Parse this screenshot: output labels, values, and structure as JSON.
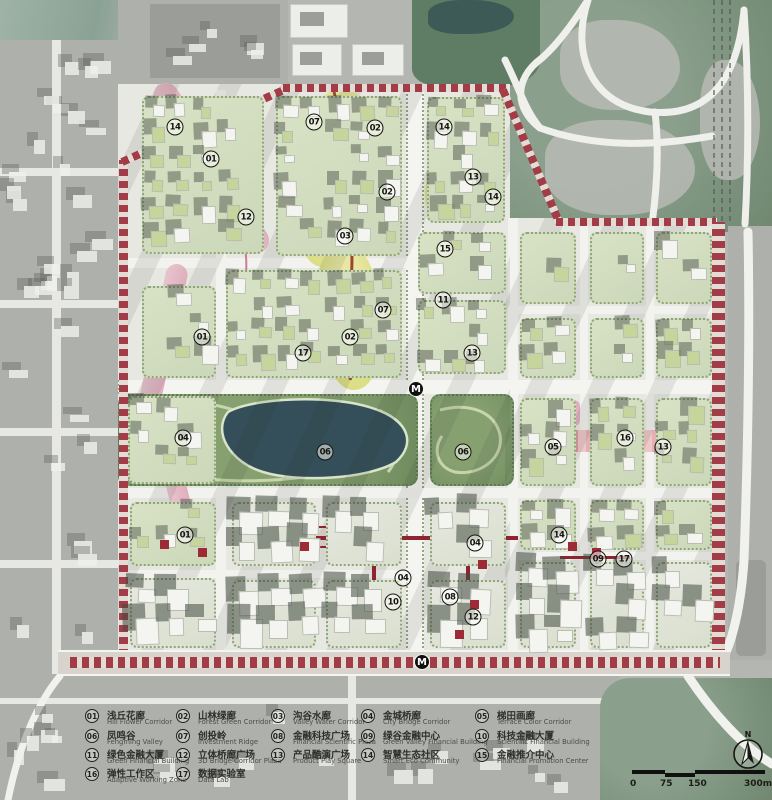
{
  "map": {
    "metro_label": "M",
    "metro_stations": [
      {
        "x": 416,
        "y": 389
      },
      {
        "x": 422,
        "y": 662
      }
    ],
    "markers": [
      {
        "label": "14",
        "x": 175,
        "y": 127
      },
      {
        "label": "01",
        "x": 211,
        "y": 159
      },
      {
        "label": "12",
        "x": 246,
        "y": 217
      },
      {
        "label": "07",
        "x": 314,
        "y": 122
      },
      {
        "label": "02",
        "x": 375,
        "y": 128
      },
      {
        "label": "02",
        "x": 387,
        "y": 192
      },
      {
        "label": "03",
        "x": 345,
        "y": 236
      },
      {
        "label": "14",
        "x": 444,
        "y": 127
      },
      {
        "label": "13",
        "x": 473,
        "y": 177
      },
      {
        "label": "14",
        "x": 493,
        "y": 197
      },
      {
        "label": "15",
        "x": 445,
        "y": 249
      },
      {
        "label": "11",
        "x": 443,
        "y": 300
      },
      {
        "label": "13",
        "x": 472,
        "y": 353
      },
      {
        "label": "01",
        "x": 202,
        "y": 337
      },
      {
        "label": "17",
        "x": 303,
        "y": 353
      },
      {
        "label": "02",
        "x": 350,
        "y": 337
      },
      {
        "label": "07",
        "x": 383,
        "y": 310
      },
      {
        "label": "04",
        "x": 183,
        "y": 438
      },
      {
        "label": "01",
        "x": 185,
        "y": 535
      },
      {
        "label": "06",
        "x": 325,
        "y": 452
      },
      {
        "label": "06",
        "x": 463,
        "y": 452
      },
      {
        "label": "05",
        "x": 553,
        "y": 447
      },
      {
        "label": "16",
        "x": 625,
        "y": 438
      },
      {
        "label": "13",
        "x": 663,
        "y": 447
      },
      {
        "label": "14",
        "x": 559,
        "y": 535
      },
      {
        "label": "09",
        "x": 598,
        "y": 559
      },
      {
        "label": "17",
        "x": 624,
        "y": 559
      },
      {
        "label": "04",
        "x": 475,
        "y": 543
      },
      {
        "label": "04",
        "x": 403,
        "y": 578
      },
      {
        "label": "10",
        "x": 393,
        "y": 602
      },
      {
        "label": "08",
        "x": 450,
        "y": 597
      },
      {
        "label": "12",
        "x": 473,
        "y": 617
      }
    ],
    "north": {
      "label": "N"
    },
    "scale_bar": {
      "labels": [
        "0",
        "75",
        "150",
        "300m"
      ]
    }
  },
  "legend": {
    "items": [
      {
        "num": "01",
        "zh": "浅丘花廊",
        "en": "Hill Flower Corridor",
        "col": 0,
        "row": 0
      },
      {
        "num": "02",
        "zh": "山林绿廊",
        "en": "Forest Green Corridor",
        "col": 1,
        "row": 0
      },
      {
        "num": "03",
        "zh": "沟谷水廊",
        "en": "Valley Water Corridor",
        "col": 2,
        "row": 0
      },
      {
        "num": "04",
        "zh": "金城桥廊",
        "en": "City Bridge Corridor",
        "col": 3,
        "row": 0
      },
      {
        "num": "05",
        "zh": "梯田画廊",
        "en": "Terrace Color Corridor",
        "col": 4,
        "row": 0
      },
      {
        "num": "06",
        "zh": "凤鸣谷",
        "en": "Fengming Valley",
        "col": 0,
        "row": 1
      },
      {
        "num": "07",
        "zh": "创投岭",
        "en": "Investment Ridge",
        "col": 1,
        "row": 1
      },
      {
        "num": "08",
        "zh": "金融科技广场",
        "en": "Financial Scientific Plaza",
        "col": 2,
        "row": 1
      },
      {
        "num": "09",
        "zh": "绿谷金融中心",
        "en": "Green Valley Financial Building",
        "col": 3,
        "row": 1
      },
      {
        "num": "10",
        "zh": "科技金融大厦",
        "en": "Scientific Financial Building",
        "col": 4,
        "row": 1
      },
      {
        "num": "11",
        "zh": "绿色金融大厦",
        "en": "Green Financial Building",
        "col": 0,
        "row": 2
      },
      {
        "num": "12",
        "zh": "立体桥廊广场",
        "en": "3D Bridge Corridor Plaza",
        "col": 1,
        "row": 2
      },
      {
        "num": "13",
        "zh": "产品酷演广场",
        "en": "Product Play Square",
        "col": 2,
        "row": 2
      },
      {
        "num": "14",
        "zh": "智慧生态社区",
        "en": "Smart Eco Community",
        "col": 3,
        "row": 2
      },
      {
        "num": "15",
        "zh": "金融推介中心",
        "en": "Financial Promotion Center",
        "col": 4,
        "row": 2
      },
      {
        "num": "16",
        "zh": "弹性工作区",
        "en": "Adaptive Working Zone",
        "col": 0,
        "row": 3
      },
      {
        "num": "17",
        "zh": "数据实验室",
        "en": "Data Lab",
        "col": 1,
        "row": 3
      }
    ]
  },
  "colors": {
    "boundary_red": "#a23c47",
    "corridor_red": "#8d2430",
    "lake": "#344f59",
    "park_green": "#7a9566",
    "parcel_green": "#d2dcc0",
    "pink_corridor": "#dfa9ba",
    "yellow_corridor": "#d9dd7f"
  }
}
